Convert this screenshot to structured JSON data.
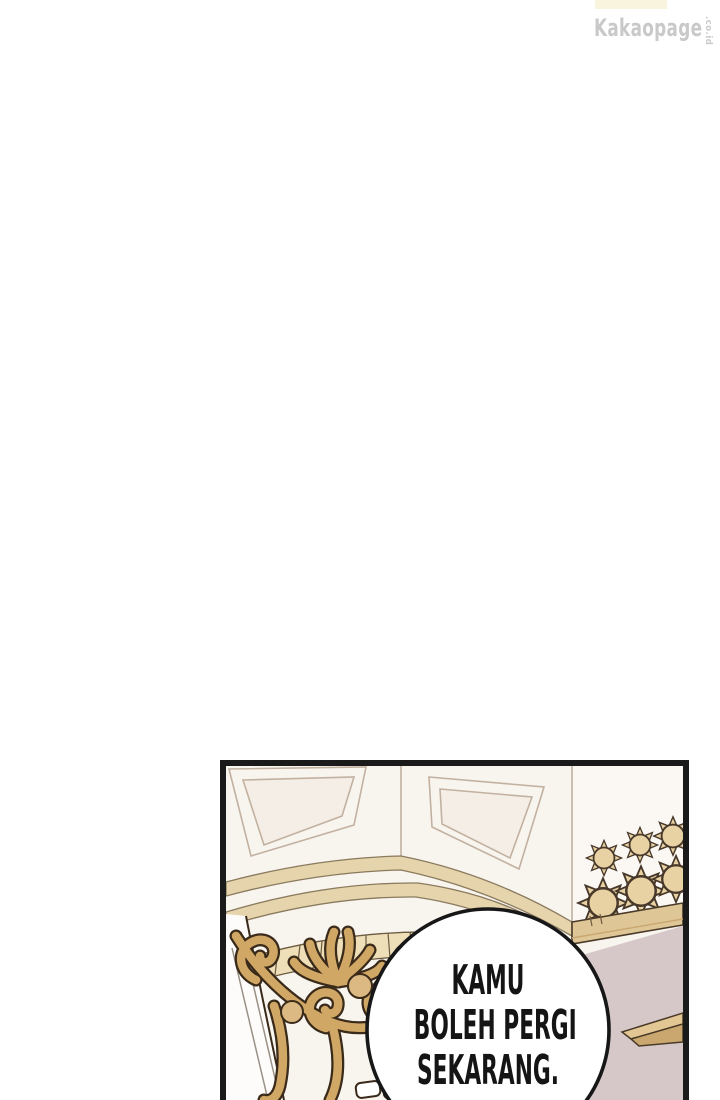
{
  "page": {
    "width": 720,
    "height": 1100
  },
  "watermark": {
    "brand": "Kakaopage",
    "suffix": ".co.id"
  },
  "speech_bubble": {
    "lines": [
      "KAMU",
      "BOLEH PERGI",
      "SEKARANG."
    ]
  },
  "colors": {
    "page_bg": "#ffffff",
    "watermark_text": "#c9c9c9",
    "watermark_banner": "#f8f4de",
    "panel_border": "#1a1a1a",
    "panel_bg": "#f8f4ee",
    "wall_line": "#c2b1a0",
    "panel_inset": "#f4eee6",
    "right_wall": "#fbf8f3",
    "trim_fill": "#e6d4ac",
    "trim_line": "#8a7a5e",
    "block_fill": "#eedfb8",
    "block_line": "#6b5a40",
    "sun_fill": "#e8d2a4",
    "sun_line": "#47382a",
    "baseboard_fill": "#dfc697",
    "baseboard_line": "#4a3a28",
    "floor_fill": "#d6c8c8",
    "table_top": "#e2c694",
    "table_side": "#c9a76f",
    "gold_fill": "#d0a765",
    "gold_light": "#dcb983",
    "gold_line": "#3a2a1a",
    "step_fill": "#fdfcfa",
    "step_line": "#9a9186",
    "bubble_fill": "#ffffff",
    "bubble_stroke": "#171717",
    "bubble_text": "#151515"
  }
}
